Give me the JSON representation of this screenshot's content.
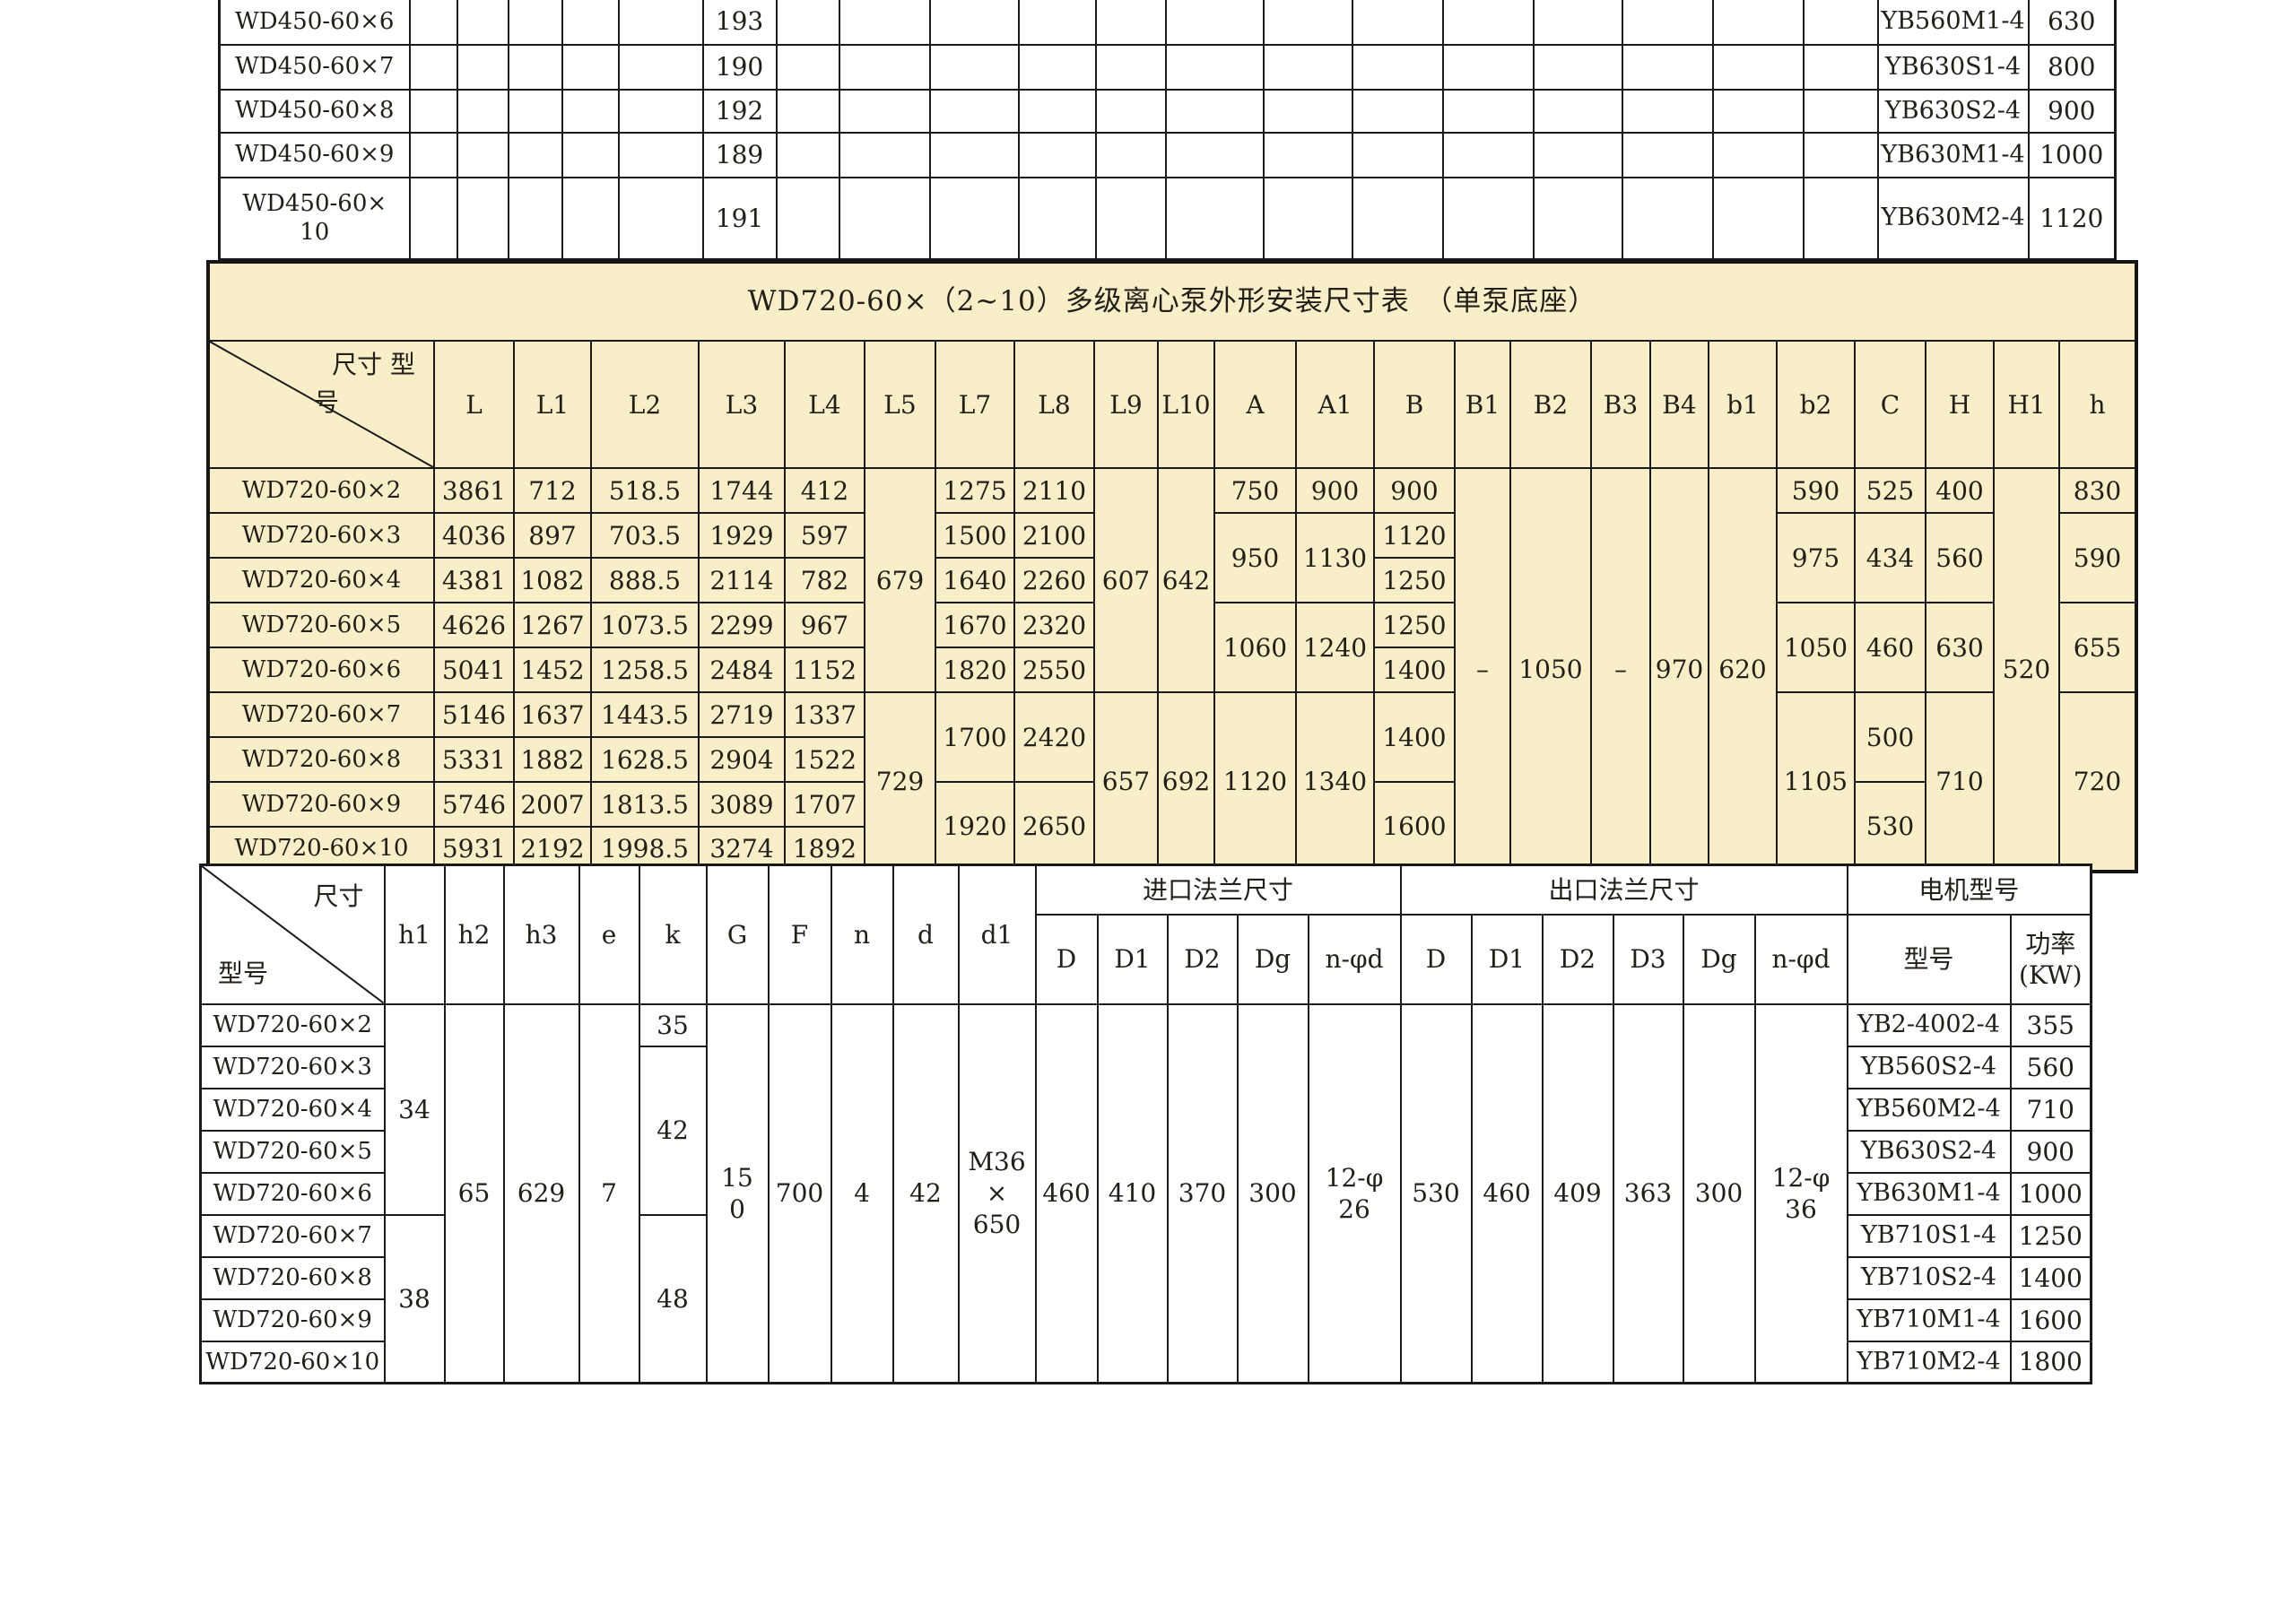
{
  "colors": {
    "yellow_bg": "#f8eec8",
    "border": "#1a1a1a",
    "text": "#221e18"
  },
  "top": {
    "rows": [
      {
        "model": "WD450-60×6",
        "v": "193",
        "motor": "YB560M1-4",
        "power": "630"
      },
      {
        "model": "WD450-60×7",
        "v": "190",
        "motor": "YB630S1-4",
        "power": "800"
      },
      {
        "model": "WD450-60×8",
        "v": "192",
        "motor": "YB630S2-4",
        "power": "900"
      },
      {
        "model": "WD450-60×9",
        "v": "189",
        "motor": "YB630M1-4",
        "power": "1000"
      },
      {
        "model": "WD450-60×\n10",
        "v": "191",
        "motor": "YB630M2-4",
        "power": "1120"
      }
    ]
  },
  "mid": {
    "title": "WD720-60×（2~10）多级离心泵外形安装尺寸表　（单泵底座）",
    "corner_line1": "尺寸 型",
    "corner_line2": "号",
    "headers": [
      "L",
      "L1",
      "L2",
      "L3",
      "L4",
      "L5",
      "L7",
      "L8",
      "L9",
      "L10",
      "A",
      "A1",
      "B",
      "B1",
      "B2",
      "B3",
      "B4",
      "b1",
      "b2",
      "C",
      "H",
      "H1",
      "h"
    ],
    "r2": {
      "model": "WD720-60×2",
      "L": "3861",
      "L1": "712",
      "L2": "518.5",
      "L3": "1744",
      "L4": "412",
      "L5": "679",
      "L7": "1275",
      "L8": "2110",
      "L9": "607",
      "L10": "642",
      "A": "750",
      "A1": "900",
      "B": "900",
      "B1": "–",
      "B2": "1050",
      "B3": "–",
      "B4": "970",
      "b1": "620",
      "b2": "590",
      "C": "525",
      "H": "400",
      "H1": "520",
      "h": "830"
    },
    "r3": {
      "model": "WD720-60×3",
      "L": "4036",
      "L1": "897",
      "L2": "703.5",
      "L3": "1929",
      "L4": "597",
      "L7": "1500",
      "L8": "2100",
      "A": "950",
      "A1": "1130",
      "B": "1120",
      "b2": "975",
      "C": "434",
      "H": "560",
      "h": "590"
    },
    "r4": {
      "model": "WD720-60×4",
      "L": "4381",
      "L1": "1082",
      "L2": "888.5",
      "L3": "2114",
      "L4": "782",
      "L7": "1640",
      "L8": "2260",
      "B": "1250"
    },
    "r5": {
      "model": "WD720-60×5",
      "L": "4626",
      "L1": "1267",
      "L2": "1073.5",
      "L3": "2299",
      "L4": "967",
      "L7": "1670",
      "L8": "2320",
      "A": "1060",
      "A1": "1240",
      "B": "1250",
      "b2": "1050",
      "C": "460",
      "H": "630",
      "h": "655"
    },
    "r6": {
      "model": "WD720-60×6",
      "L": "5041",
      "L1": "1452",
      "L2": "1258.5",
      "L3": "2484",
      "L4": "1152",
      "L7": "1820",
      "L8": "2550",
      "B": "1400"
    },
    "r7": {
      "model": "WD720-60×7",
      "L": "5146",
      "L1": "1637",
      "L2": "1443.5",
      "L3": "2719",
      "L4": "1337",
      "L5": "729",
      "L7": "1700",
      "L8": "2420",
      "L9": "657",
      "L10": "692",
      "A": "1120",
      "A1": "1340",
      "B": "1400",
      "b2": "1105",
      "C": "500",
      "H": "710",
      "h": "720"
    },
    "r8": {
      "model": "WD720-60×8",
      "L": "5331",
      "L1": "1882",
      "L2": "1628.5",
      "L3": "2904",
      "L4": "1522"
    },
    "r9": {
      "model": "WD720-60×9",
      "L": "5746",
      "L1": "2007",
      "L2": "1813.5",
      "L3": "3089",
      "L4": "1707",
      "L7": "1920",
      "L8": "2650",
      "B": "1600",
      "C": "530"
    },
    "r10": {
      "model": "WD720-60×10",
      "L": "5931",
      "L1": "2192",
      "L2": "1998.5",
      "L3": "3274",
      "L4": "1892"
    }
  },
  "bot": {
    "corner_top": "尺寸",
    "corner_bottom": "型号",
    "headers": [
      "h1",
      "h2",
      "h3",
      "e",
      "k",
      "G",
      "F",
      "n",
      "d",
      "d1"
    ],
    "group_inlet": "进口法兰尺寸",
    "group_outlet": "出口法兰尺寸",
    "group_motor": "电机型号",
    "sub_inlet": [
      "D",
      "D1",
      "D2",
      "Dg",
      "n-φd"
    ],
    "sub_outlet": [
      "D",
      "D1",
      "D2",
      "D3",
      "Dg",
      "n-φd"
    ],
    "motor_head": "型号",
    "power_head": "功率\n(KW)",
    "shared": {
      "h1a": "34",
      "h1b": "38",
      "h2": "65",
      "h3": "629",
      "e": "7",
      "ka": "35",
      "kb": "42",
      "kc": "48",
      "G": "15\n0",
      "F": "700",
      "n": "4",
      "d": "42",
      "d1": "M36\n×\n650",
      "inD": "460",
      "inD1": "410",
      "inD2": "370",
      "inDg": "300",
      "inNd": "12-φ\n26",
      "outD": "530",
      "outD1": "460",
      "outD2": "409",
      "outD3": "363",
      "outDg": "300",
      "outNd": "12-φ\n36"
    },
    "rows": [
      {
        "model": "WD720-60×2",
        "motor": "YB2-4002-4",
        "power": "355"
      },
      {
        "model": "WD720-60×3",
        "motor": "YB560S2-4",
        "power": "560"
      },
      {
        "model": "WD720-60×4",
        "motor": "YB560M2-4",
        "power": "710"
      },
      {
        "model": "WD720-60×5",
        "motor": "YB630S2-4",
        "power": "900"
      },
      {
        "model": "WD720-60×6",
        "motor": "YB630M1-4",
        "power": "1000"
      },
      {
        "model": "WD720-60×7",
        "motor": "YB710S1-4",
        "power": "1250"
      },
      {
        "model": "WD720-60×8",
        "motor": "YB710S2-4",
        "power": "1400"
      },
      {
        "model": "WD720-60×9",
        "motor": "YB710M1-4",
        "power": "1600"
      },
      {
        "model": "WD720-60×10",
        "motor": "YB710M2-4",
        "power": "1800"
      }
    ]
  }
}
